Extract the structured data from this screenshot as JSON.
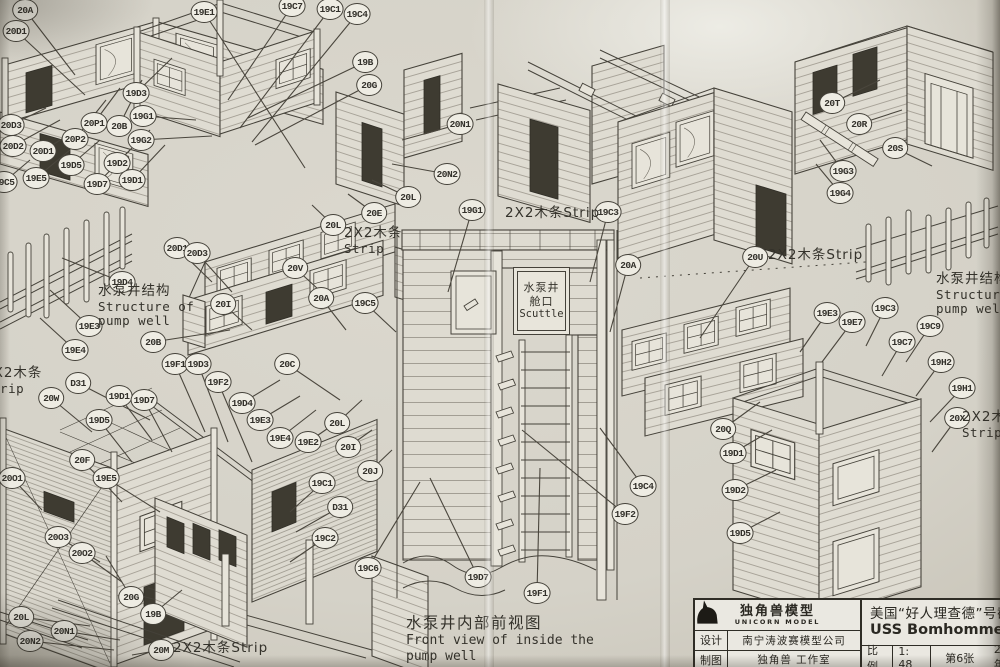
{
  "scuttle": {
    "line1": "水泵井",
    "line2": "舱口",
    "line3": "Scuttle"
  },
  "caption": {
    "cn": "水泵井内部前视图",
    "en1": "Front view of inside the",
    "en2": "pump well"
  },
  "title_block": {
    "brand_cn": "独角兽模型",
    "brand_en": "UNICORN MODEL",
    "design_label": "设计",
    "design_value": "南宁涛波赛模型公司",
    "draft_label": "制图",
    "draft_value": "独角兽 工作室",
    "title_cn": "美国“好人理查德”号截面",
    "title_en": "USS Bomhomme Ri",
    "scale_label": "比例",
    "scale_value": "1: 48",
    "sheet_no": "第6张",
    "year": "2017年"
  },
  "labels": [
    {
      "name": "pump-well-structure-label-left",
      "x": 98,
      "y": 284,
      "lines": [
        "水泵井结构",
        "Structure of",
        "pump well"
      ]
    },
    {
      "name": "pump-well-structure-label-right",
      "x": 936,
      "y": 272,
      "lines": [
        "水泵井结构",
        "Structure of",
        "pump well"
      ]
    },
    {
      "name": "strip-label-center-left",
      "x": 344,
      "y": 226,
      "lines": [
        "2X2木条",
        "Strip"
      ]
    },
    {
      "name": "strip-label-center",
      "x": 505,
      "y": 206,
      "lines": [
        "2X2木条Strip"
      ]
    },
    {
      "name": "strip-label-right",
      "x": 768,
      "y": 248,
      "lines": [
        "2X2木条Strip"
      ]
    },
    {
      "name": "strip-label-left-edge",
      "x": -16,
      "y": 366,
      "lines": [
        "2X2木条",
        "Strip"
      ]
    },
    {
      "name": "strip-label-bottom-left",
      "x": 173,
      "y": 641,
      "lines": [
        "2X2木条Strip"
      ]
    },
    {
      "name": "strip-label-right-edge",
      "x": 962,
      "y": 410,
      "lines": [
        "2X2木条",
        "Strip"
      ]
    }
  ],
  "callouts": [
    {
      "label": "20A",
      "x": 25,
      "y": 10,
      "tx": 75,
      "ty": 75
    },
    {
      "label": "20D1",
      "x": 16,
      "y": 31,
      "tx": 85,
      "ty": 95
    },
    {
      "label": "19E1",
      "x": 204,
      "y": 12,
      "tx": 305,
      "ty": 168
    },
    {
      "label": "19C7",
      "x": 292,
      "y": 6,
      "tx": 228,
      "ty": 100
    },
    {
      "label": "19C1",
      "x": 330,
      "y": 9,
      "tx": 240,
      "ty": 128
    },
    {
      "label": "19C4",
      "x": 357,
      "y": 14,
      "tx": 252,
      "ty": 142
    },
    {
      "label": "19B",
      "x": 365,
      "y": 62,
      "tx": 248,
      "ty": 118
    },
    {
      "label": "20G",
      "x": 369,
      "y": 85,
      "tx": 255,
      "ty": 145
    },
    {
      "label": "19D3",
      "x": 136,
      "y": 93,
      "tx": 172,
      "ty": 58
    },
    {
      "label": "19G1",
      "x": 143,
      "y": 116,
      "tx": 196,
      "ty": 120
    },
    {
      "label": "19G2",
      "x": 141,
      "y": 140,
      "tx": 212,
      "ty": 136
    },
    {
      "label": "20D3",
      "x": 11,
      "y": 125,
      "tx": 46,
      "ty": 108
    },
    {
      "label": "20D2",
      "x": 13,
      "y": 146,
      "tx": 60,
      "ty": 120
    },
    {
      "label": "20D1",
      "x": 43,
      "y": 151,
      "tx": 76,
      "ty": 130
    },
    {
      "label": "20P1",
      "x": 94,
      "y": 123,
      "tx": 120,
      "ty": 88
    },
    {
      "label": "20P2",
      "x": 75,
      "y": 139,
      "tx": 106,
      "ty": 100
    },
    {
      "label": "20B",
      "x": 119,
      "y": 126,
      "tx": 142,
      "ty": 80
    },
    {
      "label": "19D5",
      "x": 71,
      "y": 165,
      "tx": 100,
      "ty": 140
    },
    {
      "label": "19E5",
      "x": 36,
      "y": 178,
      "tx": 70,
      "ty": 150
    },
    {
      "label": "19D7",
      "x": 97,
      "y": 184,
      "tx": 130,
      "ty": 150
    },
    {
      "label": "19D2",
      "x": 117,
      "y": 163,
      "tx": 150,
      "ty": 130
    },
    {
      "label": "19D1",
      "x": 132,
      "y": 180,
      "tx": 165,
      "ty": 145
    },
    {
      "label": "19C5",
      "x": 4,
      "y": 182,
      "tx": 30,
      "ty": 160
    },
    {
      "label": "19D4",
      "x": 122,
      "y": 282,
      "tx": 62,
      "ty": 258
    },
    {
      "label": "19E3",
      "x": 89,
      "y": 326,
      "tx": 50,
      "ty": 290
    },
    {
      "label": "19E4",
      "x": 75,
      "y": 350,
      "tx": 40,
      "ty": 318
    },
    {
      "label": "20B",
      "x": 153,
      "y": 342,
      "tx": 230,
      "ty": 330
    },
    {
      "label": "19F1",
      "x": 175,
      "y": 364,
      "tx": 205,
      "ty": 432
    },
    {
      "label": "19D3",
      "x": 198,
      "y": 364,
      "tx": 228,
      "ty": 442
    },
    {
      "label": "19F2",
      "x": 218,
      "y": 382,
      "tx": 252,
      "ty": 462
    },
    {
      "label": "D31",
      "x": 78,
      "y": 383,
      "tx": 150,
      "ty": 420
    },
    {
      "label": "20D1",
      "x": 177,
      "y": 248,
      "tx": 212,
      "ty": 282
    },
    {
      "label": "20D3",
      "x": 197,
      "y": 253,
      "tx": 232,
      "ty": 292
    },
    {
      "label": "20I",
      "x": 223,
      "y": 304,
      "tx": 252,
      "ty": 330
    },
    {
      "label": "20V",
      "x": 295,
      "y": 268,
      "tx": 330,
      "ty": 300
    },
    {
      "label": "20A",
      "x": 321,
      "y": 298,
      "tx": 346,
      "ty": 330
    },
    {
      "label": "19C5",
      "x": 365,
      "y": 303,
      "tx": 396,
      "ty": 332
    },
    {
      "label": "20C",
      "x": 287,
      "y": 364,
      "tx": 340,
      "ty": 400
    },
    {
      "label": "20W",
      "x": 51,
      "y": 398,
      "tx": 92,
      "ty": 432
    },
    {
      "label": "19D1",
      "x": 119,
      "y": 396,
      "tx": 152,
      "ty": 440
    },
    {
      "label": "19D7",
      "x": 144,
      "y": 400,
      "tx": 172,
      "ty": 452
    },
    {
      "label": "19D5",
      "x": 99,
      "y": 420,
      "tx": 132,
      "ty": 462
    },
    {
      "label": "20F",
      "x": 82,
      "y": 460,
      "tx": 122,
      "ty": 502
    },
    {
      "label": "19E5",
      "x": 106,
      "y": 478,
      "tx": 160,
      "ty": 512
    },
    {
      "label": "20O1",
      "x": 12,
      "y": 478,
      "tx": 42,
      "ty": 510
    },
    {
      "label": "20O3",
      "x": 58,
      "y": 537,
      "tx": 100,
      "ty": 562
    },
    {
      "label": "20O2",
      "x": 82,
      "y": 553,
      "tx": 122,
      "ty": 582
    },
    {
      "label": "20G",
      "x": 131,
      "y": 597,
      "tx": 106,
      "ty": 556
    },
    {
      "label": "19B",
      "x": 153,
      "y": 614,
      "tx": 182,
      "ty": 590
    },
    {
      "label": "20L",
      "x": 21,
      "y": 617,
      "tx": 90,
      "ty": 626
    },
    {
      "label": "20N1",
      "x": 64,
      "y": 631,
      "tx": 120,
      "ty": 640
    },
    {
      "label": "20N2",
      "x": 30,
      "y": 641,
      "tx": 114,
      "ty": 650
    },
    {
      "label": "20M",
      "x": 161,
      "y": 650,
      "tx": 132,
      "ty": 655
    },
    {
      "label": "19D4",
      "x": 242,
      "y": 403,
      "tx": 280,
      "ty": 380
    },
    {
      "label": "19E3",
      "x": 260,
      "y": 420,
      "tx": 300,
      "ty": 396
    },
    {
      "label": "19E4",
      "x": 280,
      "y": 438,
      "tx": 316,
      "ty": 410
    },
    {
      "label": "19E2",
      "x": 308,
      "y": 442,
      "tx": 340,
      "ty": 420
    },
    {
      "label": "20L",
      "x": 337,
      "y": 423,
      "tx": 362,
      "ty": 400
    },
    {
      "label": "20I",
      "x": 348,
      "y": 447,
      "tx": 372,
      "ty": 430
    },
    {
      "label": "20J",
      "x": 370,
      "y": 471,
      "tx": 392,
      "ty": 450
    },
    {
      "label": "19C1",
      "x": 322,
      "y": 483,
      "tx": 290,
      "ty": 512
    },
    {
      "label": "D31",
      "x": 340,
      "y": 507,
      "tx": 296,
      "ty": 532
    },
    {
      "label": "19C2",
      "x": 325,
      "y": 538,
      "tx": 290,
      "ty": 562
    },
    {
      "label": "19C6",
      "x": 368,
      "y": 568,
      "tx": 420,
      "ty": 482
    },
    {
      "label": "19D7",
      "x": 478,
      "y": 577,
      "tx": 430,
      "ty": 478
    },
    {
      "label": "19F1",
      "x": 537,
      "y": 593,
      "tx": 540,
      "ty": 468
    },
    {
      "label": "19F2",
      "x": 625,
      "y": 514,
      "tx": 522,
      "ty": 430
    },
    {
      "label": "19C4",
      "x": 643,
      "y": 486,
      "tx": 600,
      "ty": 428
    },
    {
      "label": "19G1",
      "x": 472,
      "y": 210,
      "tx": 448,
      "ty": 292
    },
    {
      "label": "19C3",
      "x": 608,
      "y": 212,
      "tx": 590,
      "ty": 282
    },
    {
      "label": "20A",
      "x": 628,
      "y": 265,
      "tx": 610,
      "ty": 332
    },
    {
      "label": "20N1",
      "x": 460,
      "y": 124,
      "tx": 402,
      "ty": 140
    },
    {
      "label": "20N2",
      "x": 447,
      "y": 174,
      "tx": 392,
      "ty": 164
    },
    {
      "label": "20L",
      "x": 408,
      "y": 197,
      "tx": 372,
      "ty": 180
    },
    {
      "label": "20E",
      "x": 374,
      "y": 213,
      "tx": 348,
      "ty": 194
    },
    {
      "label": "20L",
      "x": 333,
      "y": 225,
      "tx": 312,
      "ty": 205
    },
    {
      "label": "20T",
      "x": 832,
      "y": 103,
      "tx": 880,
      "ty": 80
    },
    {
      "label": "20R",
      "x": 859,
      "y": 124,
      "tx": 902,
      "ty": 110
    },
    {
      "label": "20S",
      "x": 895,
      "y": 148,
      "tx": 932,
      "ty": 166
    },
    {
      "label": "19G3",
      "x": 843,
      "y": 171,
      "tx": 820,
      "ty": 140
    },
    {
      "label": "19G4",
      "x": 840,
      "y": 193,
      "tx": 816,
      "ty": 164
    },
    {
      "label": "20U",
      "x": 755,
      "y": 257,
      "tx": 700,
      "ty": 338
    },
    {
      "label": "19E3",
      "x": 827,
      "y": 313,
      "tx": 800,
      "ty": 352
    },
    {
      "label": "19E7",
      "x": 852,
      "y": 322,
      "tx": 822,
      "ty": 362
    },
    {
      "label": "19C3",
      "x": 885,
      "y": 308,
      "tx": 866,
      "ty": 346
    },
    {
      "label": "19C9",
      "x": 930,
      "y": 326,
      "tx": 906,
      "ty": 362
    },
    {
      "label": "19C7",
      "x": 902,
      "y": 342,
      "tx": 882,
      "ty": 376
    },
    {
      "label": "19H2",
      "x": 941,
      "y": 362,
      "tx": 916,
      "ty": 396
    },
    {
      "label": "19H1",
      "x": 962,
      "y": 388,
      "tx": 930,
      "ty": 422
    },
    {
      "label": "20Q",
      "x": 723,
      "y": 429,
      "tx": 760,
      "ty": 402
    },
    {
      "label": "19D1",
      "x": 733,
      "y": 453,
      "tx": 772,
      "ty": 430
    },
    {
      "label": "19D2",
      "x": 735,
      "y": 490,
      "tx": 776,
      "ty": 470
    },
    {
      "label": "19D5",
      "x": 740,
      "y": 533,
      "tx": 780,
      "ty": 512
    },
    {
      "label": "20X",
      "x": 957,
      "y": 418,
      "tx": 932,
      "ty": 452
    }
  ]
}
